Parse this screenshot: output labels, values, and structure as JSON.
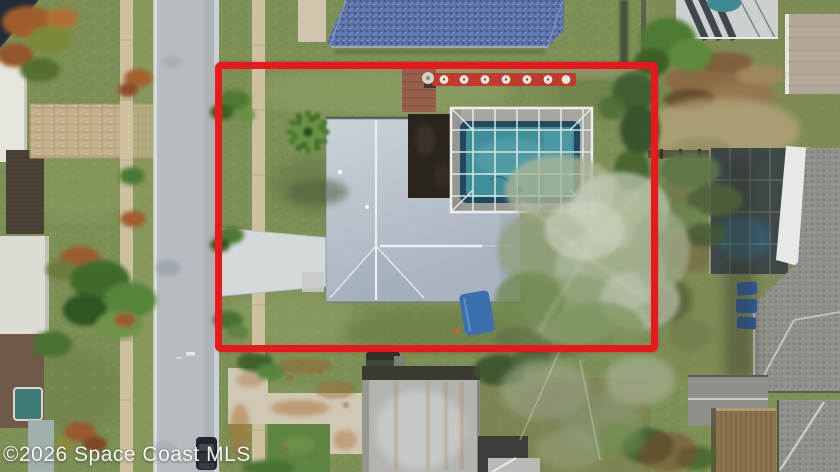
{
  "watermark": {
    "text": "©2026 Space Coast MLS"
  },
  "scene": {
    "type": "aerial-drone-photo",
    "subject": "Overhead drone view of a single-family home lot with a screened swimming pool, outlined by a red property boundary rectangle",
    "elements": [
      "street",
      "public-sidewalk",
      "concrete-driveway",
      "paver-driveway",
      "main-house-gray-roof",
      "dark-flat-roof-section",
      "screened-pool-enclosure",
      "swimming-pool",
      "front-lawn",
      "palm-trees",
      "bare-oak-tree",
      "neighbor-house-blue-roof",
      "neighbor-house-shingle-roof",
      "neighbor-screened-pool",
      "red-bench-row",
      "brick-patio",
      "blue-tarp",
      "blue-bins",
      "wood-shed",
      "parked-car",
      "palm-frond-debris-pile",
      "watermark"
    ]
  },
  "palette": {
    "boundary": "#e8191d",
    "grass": "#7d9055",
    "grassLight": "#95a468",
    "grassDark": "#5f7443",
    "street": "#b6bcc0",
    "curb": "#d9dbdc",
    "sidewalk": "#cdc1a0",
    "paver": "#c3b08c",
    "driveway": "#d4d9db",
    "roofMain": "#bcc6cf",
    "roofDark": "#29241e",
    "ridge": "#eef1f4",
    "poolDeck": "#a7a6a1",
    "poolCoping": "#1f4a60",
    "poolWater": "#3f8e99",
    "cage": "#edefec",
    "roofBlue": "#5a6fa6",
    "shingle": "#8f9089",
    "paleRoof": "#b2b4b0",
    "palmGreen": "#4e7a33",
    "palmRust": "#a05c2c",
    "treePale": "#a9b496",
    "treeGreen": "#6f8a52",
    "bushDark": "#3f5c2f",
    "debris": "#8a6a44",
    "sand": "#b5a37c",
    "bench": "#c03a2e",
    "brick": "#96604b",
    "tarp": "#3c6fae",
    "bins": "#2e5ea6",
    "shed": "#8b744e",
    "fence": "#57503e",
    "car": "#23262a",
    "concrete": "#cfc8b4",
    "rust": "#b06f3a",
    "tanRoof": "#b3a897",
    "watermarkColor": "#ffffff"
  }
}
